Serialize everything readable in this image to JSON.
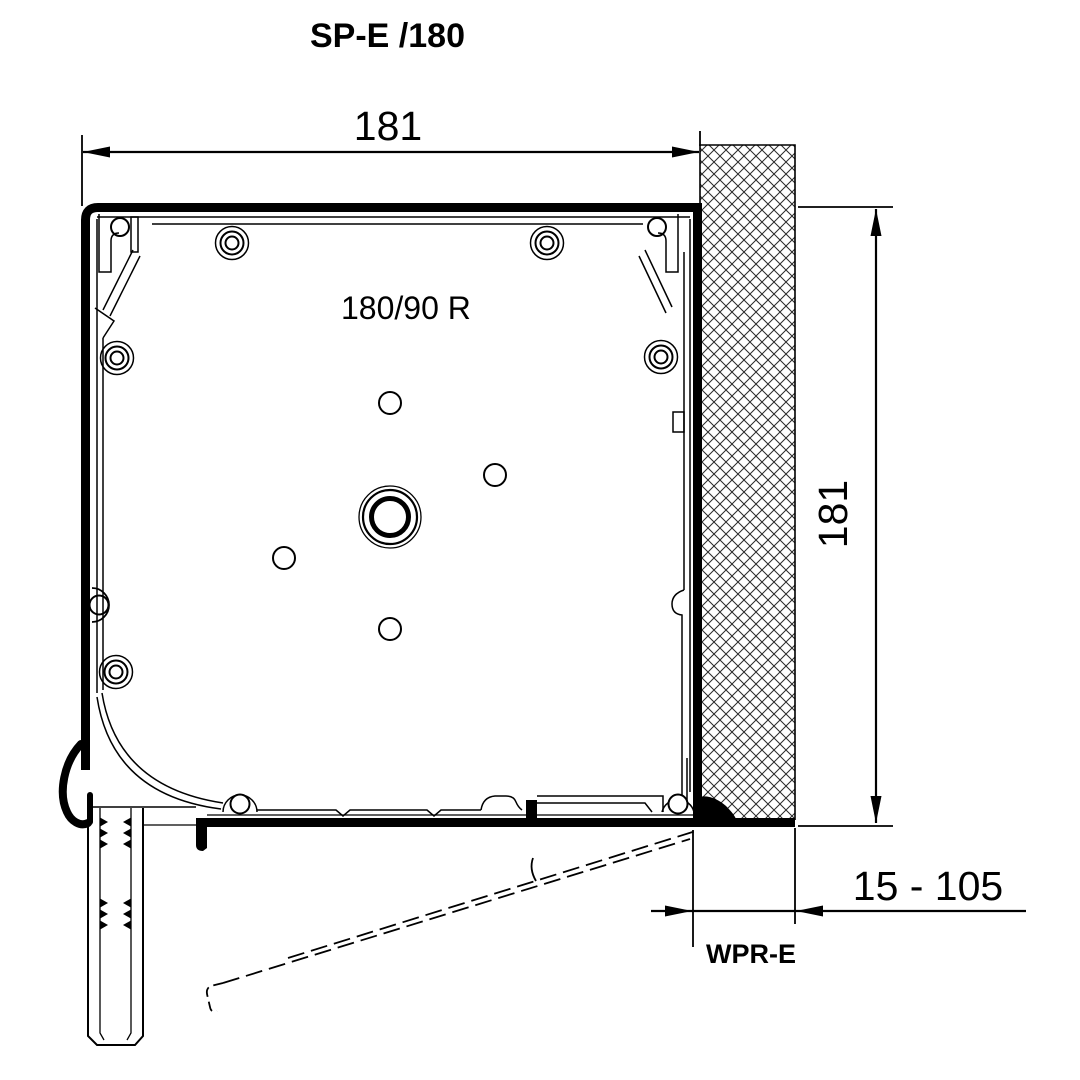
{
  "title": "SP-E /180",
  "dimensions": {
    "top_width": "181",
    "right_height": "181",
    "depth_range": "15 - 105"
  },
  "labels": {
    "box_model": "180/90 R",
    "adapter_profile": "WPR-E"
  },
  "colors": {
    "ink": "#000000",
    "background": "#ffffff",
    "hatch": "#2a2a2a"
  }
}
